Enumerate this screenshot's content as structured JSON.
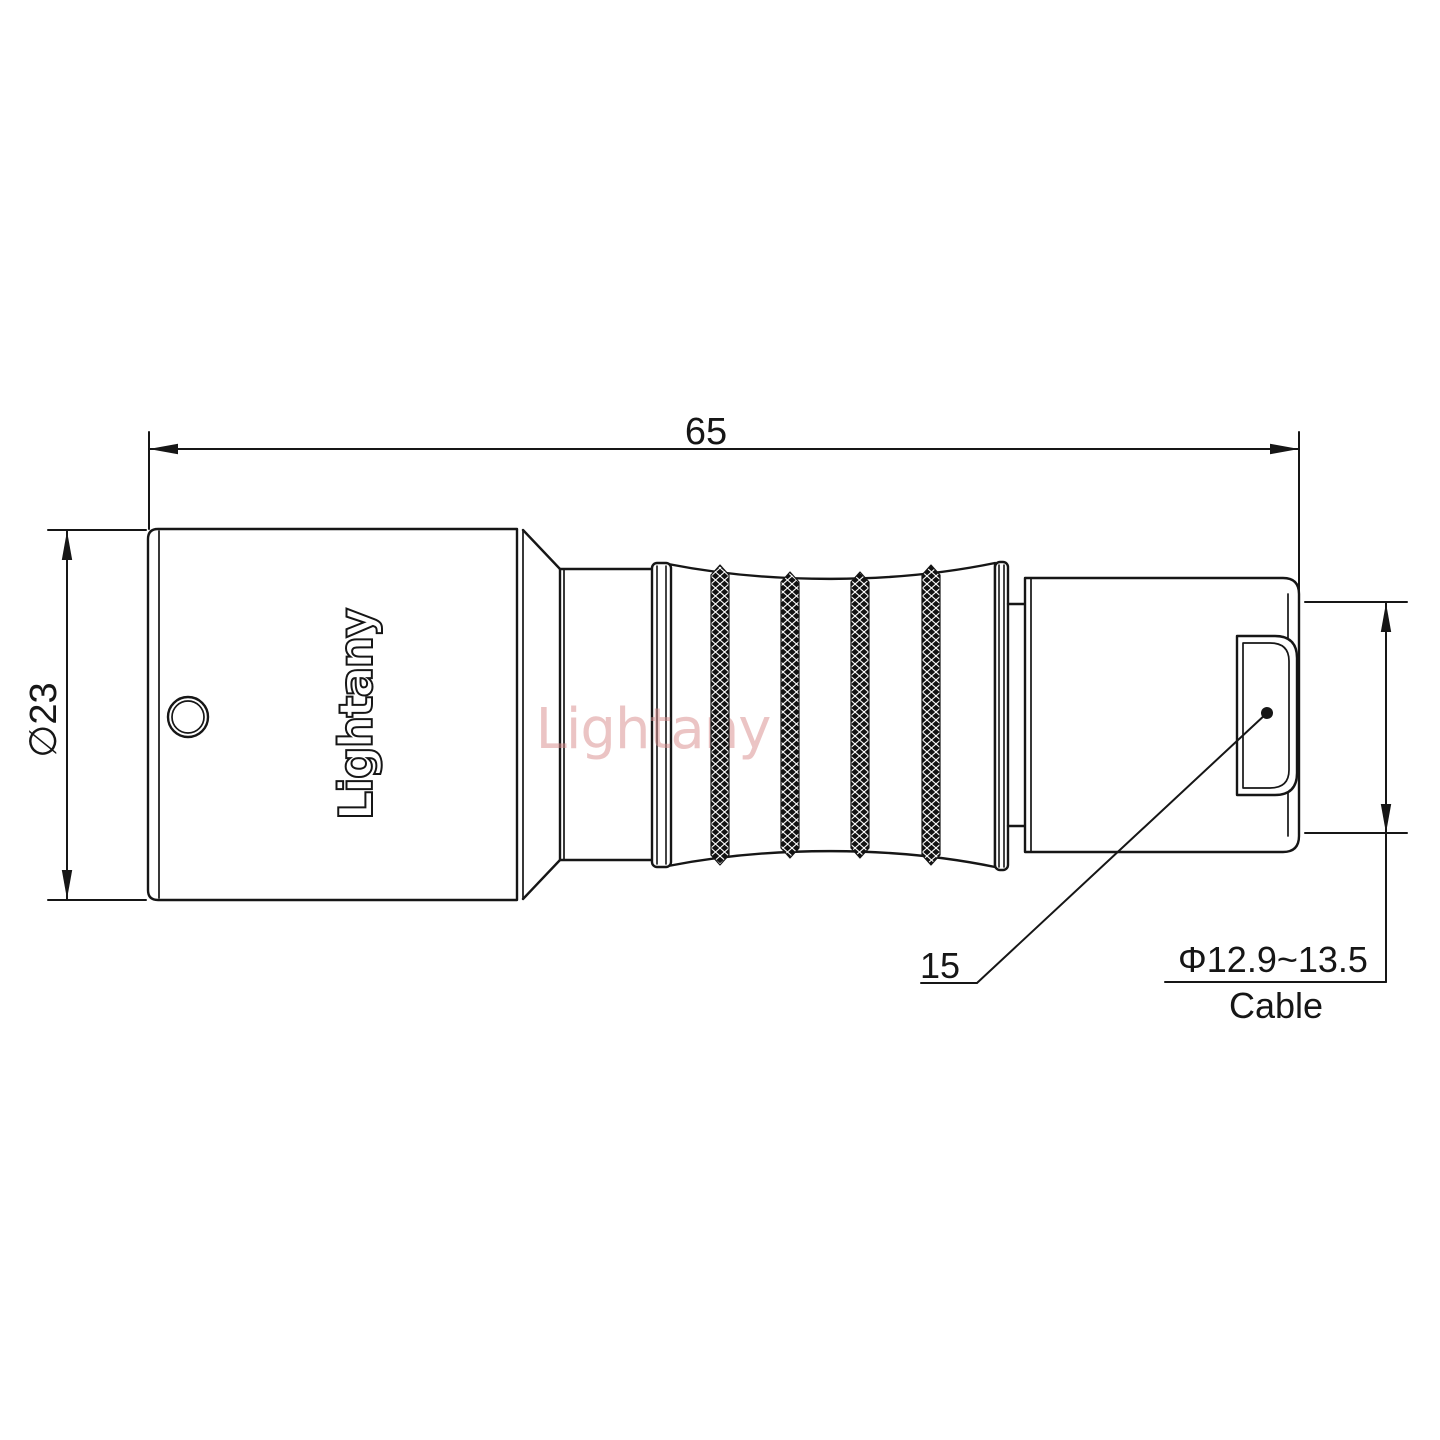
{
  "brand": {
    "logo_text": "Lightany",
    "watermark_text": "Lightany"
  },
  "dimensions": {
    "overall_length": "65",
    "body_diameter": "∅23",
    "rear_nut_length": "15",
    "cable_diameter_range": "Φ12.9~13.5",
    "cable_label": "Cable"
  },
  "colors": {
    "line": "#161616",
    "watermark": "#d98a8a",
    "paper": "#ffffff"
  }
}
